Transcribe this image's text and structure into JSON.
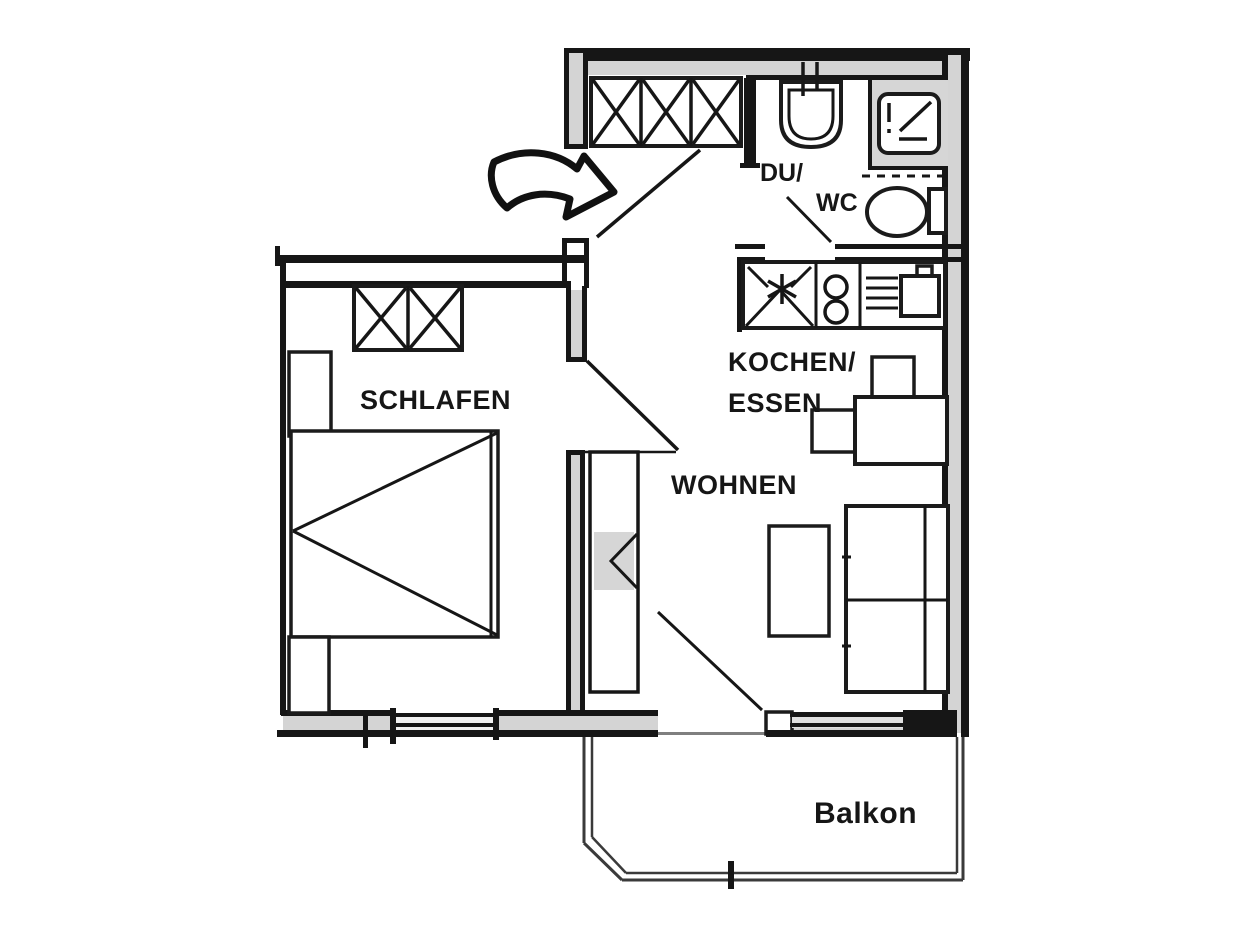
{
  "document": {
    "type": "apartment-floor-plan"
  },
  "labels": {
    "bedroom": "SCHLAFEN",
    "living": "WOHNEN",
    "kitchen_line1": "KOCHEN/",
    "kitchen_line2": "ESSEN",
    "bath_line1": "DU/",
    "bath_line2": "WC",
    "balcony": "Balkon"
  },
  "colors": {
    "line": "#161616",
    "wall_cavity": "#d4d4d4",
    "fixture_shade": "#d6d6d6",
    "background": "#ffffff"
  },
  "rooms": [
    {
      "id": "schlafen",
      "name": "bedroom"
    },
    {
      "id": "wohnen",
      "name": "living-room"
    },
    {
      "id": "kochen-essen",
      "name": "kitchen-dining"
    },
    {
      "id": "du-wc",
      "name": "shower-wc"
    },
    {
      "id": "balkon",
      "name": "balcony"
    },
    {
      "id": "flur",
      "name": "entrance-hall"
    }
  ],
  "symbols": [
    "entrance-arrow",
    "entrance-door-swing",
    "hall-wardrobe",
    "bedroom-wardrobe",
    "bed",
    "nightstand",
    "dresser",
    "bedroom-door-swing",
    "corridor-shelf",
    "washbasin",
    "shower",
    "toilet",
    "bath-door-swing",
    "kitchen-counter",
    "hob-plates",
    "kitchen-sink",
    "dining-table",
    "dining-chairs",
    "coffee-table",
    "sofa",
    "balcony-door",
    "windows",
    "balcony-railing"
  ]
}
